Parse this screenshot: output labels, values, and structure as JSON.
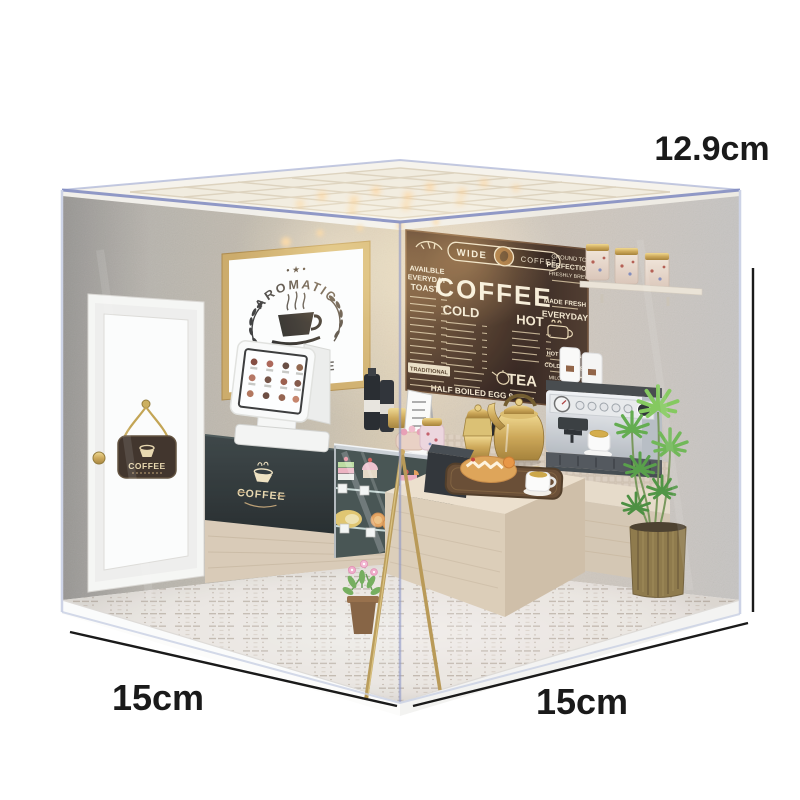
{
  "annotations": {
    "height": "12.9cm",
    "depth": "15cm",
    "width": "15cm"
  },
  "menu_board": {
    "banner_left": "WIDE",
    "banner_right": "COFFEE",
    "corner_line1": "GROUND TO",
    "corner_line2": "PERFECTION",
    "corner_line3": "FRESHLY BREW",
    "left_line1": "AVAILBLE",
    "left_line2": "EVERYDAY",
    "left_line3": "TOAST",
    "headline": "COFFEE",
    "cold_header": "COLD",
    "hot_header": "HOT",
    "right_line1": "MADE FRESH",
    "right_line2": "EVERYDAY",
    "hot_drinks": "HOT DRINKS",
    "cold_drinks": "COLD DRINKS",
    "milo_ice": "MILO ICE",
    "tea_header": "TEA",
    "traditional": "TRADITIONAL",
    "bottom_line": "HALF BOILED EGG 9"
  },
  "poster": {
    "decoration": "• ★ •",
    "arched_text": "AROMATIC",
    "partial_text": "FE"
  },
  "door_sign": {
    "text": "COFFEE"
  },
  "counter_badge": {
    "text": "COFFEE"
  },
  "colors": {
    "background": "#ffffff",
    "wall_gray": "#b5b1ac",
    "wall_warm": "#d8c8ae",
    "menu_board_brown": "#261610",
    "cream_text": "#f2e6cc",
    "gold": "#c2a04c",
    "acrylic_edge_blue": "#7e88c0",
    "wood_light": "#e3d6c2",
    "plant_green": "#6ab84c",
    "annotation": "#1a1a1a"
  }
}
